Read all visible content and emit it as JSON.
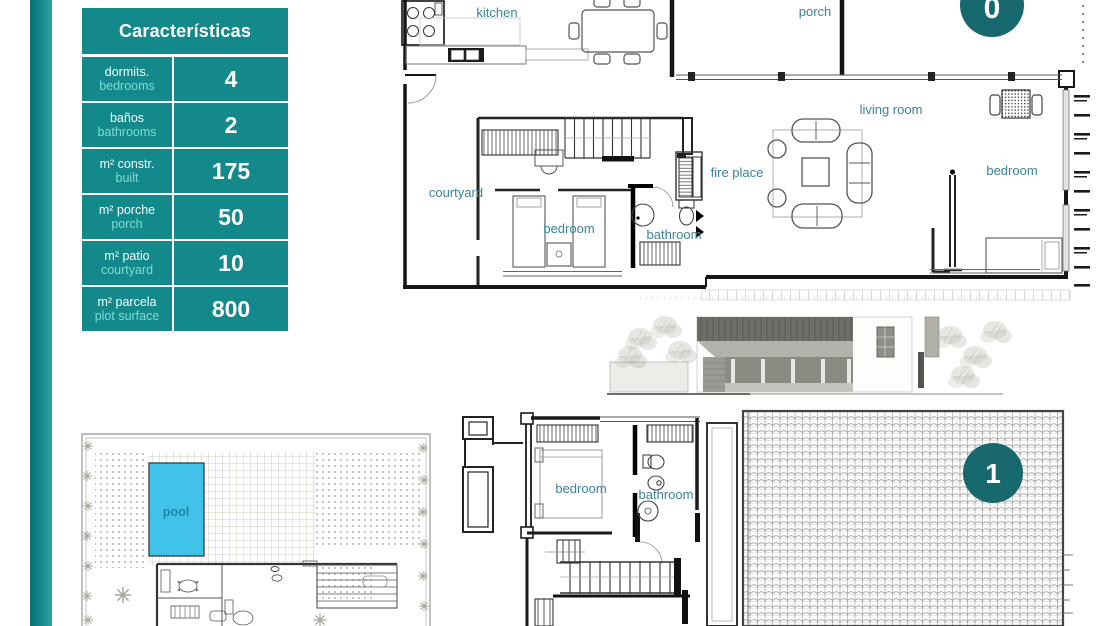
{
  "colors": {
    "accent_teal": "#13898c",
    "badge_teal": "#17696e",
    "room_label_teal": "#3b8398",
    "table_en_text": "#7fdcd4",
    "pool_blue": "#41c3e9"
  },
  "table": {
    "title": "Características",
    "rows": [
      {
        "es": "dormits.",
        "en": "bedrooms",
        "value": "4"
      },
      {
        "es": "baños",
        "en": "bathrooms",
        "value": "2"
      },
      {
        "es": "m² constr.",
        "en": "built",
        "value": "175"
      },
      {
        "es": "m² porche",
        "en": "porch",
        "value": "50"
      },
      {
        "es": "m² patio",
        "en": "courtyard",
        "value": "10"
      },
      {
        "es": "m² parcela",
        "en": "plot surface",
        "value": "800"
      }
    ]
  },
  "floor0": {
    "badge": "0",
    "labels": {
      "kitchen": "kitchen",
      "porch": "porch",
      "living_room": "living room",
      "fire_place": "fire place",
      "bedroom_right": "bedroom",
      "courtyard": "courtyard",
      "bedroom_center": "bedroom",
      "bathroom": "bathroom"
    }
  },
  "floor1": {
    "badge": "1",
    "labels": {
      "bedroom": "bedroom",
      "bathroom": "bathroom"
    }
  },
  "site_plan": {
    "labels": {
      "pool": "pool"
    }
  }
}
